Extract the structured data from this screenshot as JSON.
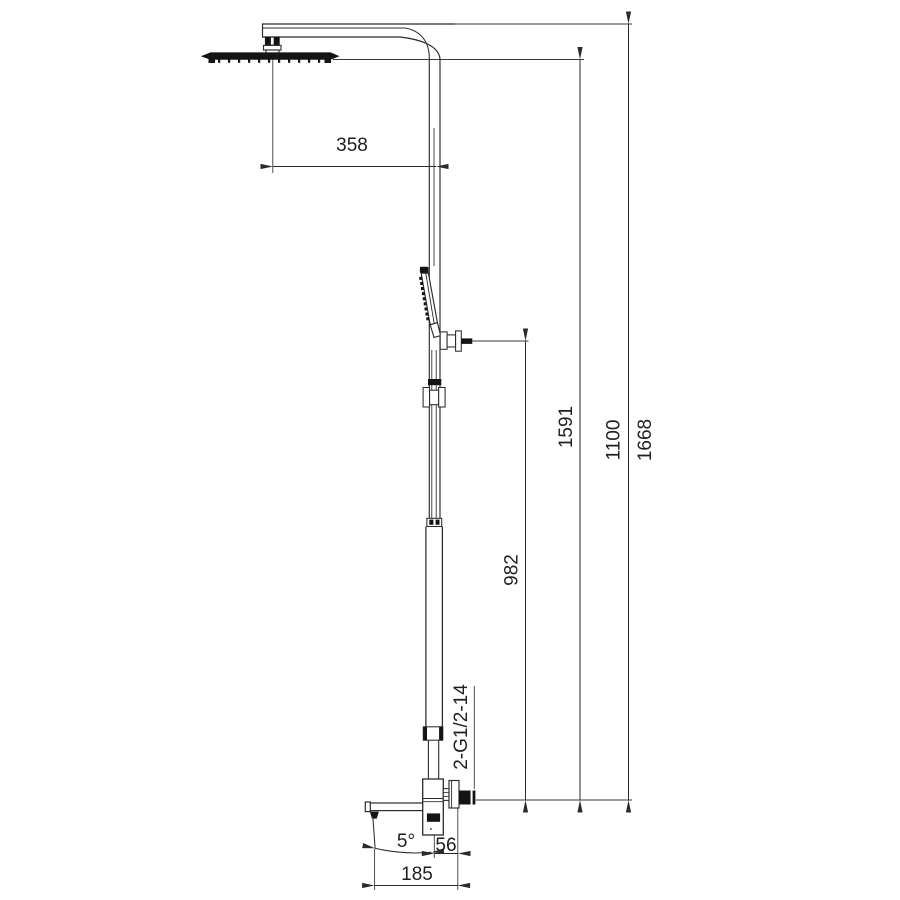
{
  "drawing": {
    "kind": "technical-dimension-drawing",
    "colors": {
      "background": "#ffffff",
      "line": "#2b2b2b",
      "dark_fill": "#141414"
    }
  },
  "dimensions": {
    "arm_reach_mm": "358",
    "hand_shower_holder_height_mm": "982",
    "shower_head_height_mm": "1591",
    "riser_height_mm": "1100",
    "total_height_mm": "1668",
    "connection_thread": "2-G1/2-14",
    "spout_tilt_angle": "5°",
    "outlet_offset_mm": "56",
    "spout_reach_mm": "185"
  }
}
